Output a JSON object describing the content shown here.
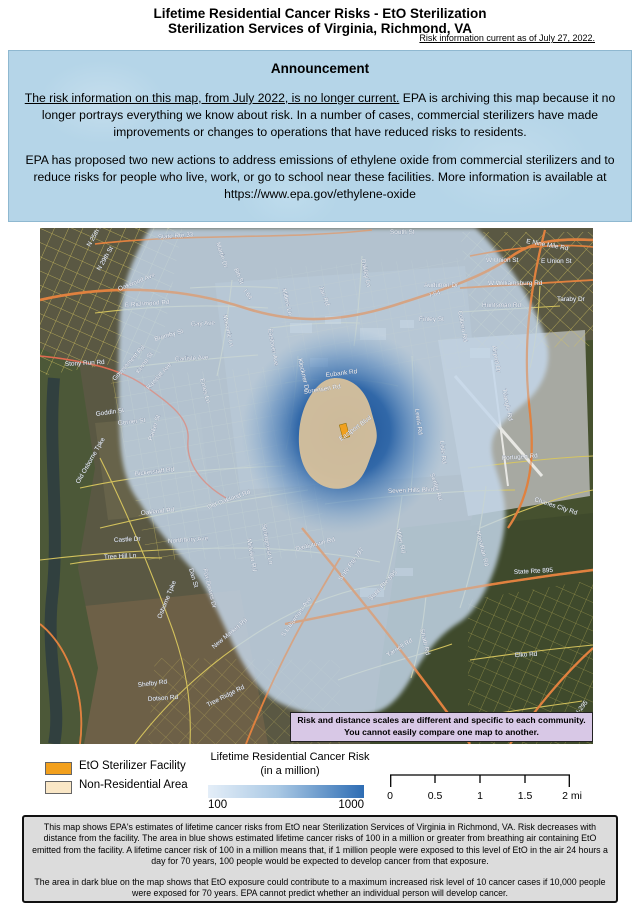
{
  "header": {
    "title1": "Lifetime Residential Cancer Risks - EtO Sterilization",
    "title2": "Sterilization Services of Virginia, Richmond, VA",
    "current_note": "Risk information current as of July 27, 2022."
  },
  "announcement": {
    "heading": "Announcement",
    "p1_underline": "The risk information on this map, from July 2022, is no longer current.",
    "p1_rest": " EPA is archiving this map because it no longer portrays everything we know about risk. In a number of cases, commercial sterilizers have made improvements or changes to operations that have reduced risks to residents.",
    "p2": "EPA has proposed two new actions to address emissions of ethylene oxide from commercial sterilizers and to reduce risks for people who live, work, or go to school near these facilities. More information is available at https://www.epa.gov/ethylene-oxide"
  },
  "map": {
    "note_line1": "Risk and distance scales are different and specific to each community.",
    "note_line2": "You cannot easily compare one map to another.",
    "labels": [
      {
        "text": "State Rte 33"
      },
      {
        "text": "I-64"
      },
      {
        "text": "I-64"
      },
      {
        "text": "Martin Dr"
      },
      {
        "text": "8th St"
      },
      {
        "text": "Masonic Ln"
      },
      {
        "text": "E Richmond Rd"
      },
      {
        "text": "Gay Ave"
      },
      {
        "text": "Bromby St"
      },
      {
        "text": "Kemp St"
      },
      {
        "text": "Carlisle Ave"
      },
      {
        "text": "Randall Ave"
      },
      {
        "text": "Emes Ln"
      },
      {
        "text": "Eastover Ave"
      },
      {
        "text": "Millers Ln"
      },
      {
        "text": "Jan Rd"
      },
      {
        "text": "Klockner Dr"
      },
      {
        "text": "South St"
      },
      {
        "text": "Oakley Ln"
      },
      {
        "text": "Audubon Dr"
      },
      {
        "text": "Finley St"
      },
      {
        "text": "Colleen Rd"
      },
      {
        "text": "E Nine Mile Rd"
      },
      {
        "text": "W Union St"
      },
      {
        "text": "E Union St"
      },
      {
        "text": "W Williamsburg Rd"
      },
      {
        "text": "Huntsman Rd"
      },
      {
        "text": "Taraby Dr"
      },
      {
        "text": "Airport Dr"
      },
      {
        "text": "Eubank Rd"
      },
      {
        "text": "Sorensen Rd"
      },
      {
        "text": "Eastport Blvd"
      },
      {
        "text": "Lewis Rd"
      },
      {
        "text": "Lisle Rd"
      },
      {
        "text": "Settler Rd"
      },
      {
        "text": "Portugee Rd"
      },
      {
        "text": "Triangle Rd"
      },
      {
        "text": "Seven Hills Blvd"
      },
      {
        "text": "Darbytown Rd"
      },
      {
        "text": "Miller Rd"
      },
      {
        "text": "Monahan Rd"
      },
      {
        "text": "State Rte 895"
      },
      {
        "text": "State Rte 895"
      },
      {
        "text": "State Rte 197"
      },
      {
        "text": "Yarnell Rd"
      },
      {
        "text": "Strath Rd"
      },
      {
        "text": "Charles City Rd"
      },
      {
        "text": "Elko Rd"
      },
      {
        "text": "S Laburnum Ave"
      },
      {
        "text": "Bickerstaff Rd"
      },
      {
        "text": "Old Oakland Rd"
      },
      {
        "text": "Oakland Rd"
      },
      {
        "text": "Northbury Ave"
      },
      {
        "text": "Tree Hill Ln"
      },
      {
        "text": "Castle Dr"
      },
      {
        "text": "Fox Downs Dr"
      },
      {
        "text": "Springcrest Ln"
      },
      {
        "text": "Midview Rd"
      },
      {
        "text": "Dan St"
      },
      {
        "text": "Goddin St"
      },
      {
        "text": "Gorner St"
      },
      {
        "text": "Parker St"
      },
      {
        "text": "Old Osborne Tpke"
      },
      {
        "text": "Osborne Tpke"
      },
      {
        "text": "New Market Rd"
      },
      {
        "text": "Tree Ridge Rd"
      },
      {
        "text": "Dotson Rd"
      },
      {
        "text": "Shelby Rd"
      },
      {
        "text": "Stony Run Rd"
      },
      {
        "text": "Government Rd"
      },
      {
        "text": "N 25th St"
      },
      {
        "text": "N 29th St"
      },
      {
        "text": "Oakwood Ave"
      },
      {
        "text": "I-295"
      }
    ]
  },
  "legend": {
    "facility_label": "EtO Sterilizer Facility",
    "non_residential_label": "Non-Residential Area",
    "risk_title": "Lifetime Residential Cancer Risk",
    "risk_subtitle": "(in a million)",
    "scale_min": "100",
    "scale_max": "1000",
    "ticks": [
      "0",
      "0.5",
      "1",
      "1.5",
      "2 mi"
    ]
  },
  "footer": {
    "p1": "This map shows EPA's estimates of lifetime cancer risks from EtO near Sterilization Services of Virginia in Richmond, VA. Risk decreases with distance from the facility. The area in blue shows estimated lifetime cancer risks of 100 in a million or greater from breathing air containing EtO emitted from the facility. A lifetime cancer risk of 100 in a million means that, if 1 million people were exposed to this level of EtO in the air 24 hours a day for 70 years, 100 people would be expected to develop cancer from that exposure.",
    "p2": "The area in dark blue on the map shows that EtO exposure could contribute to a maximum increased risk level of 10 cancer cases if 10,000 people were exposed for 70 years. EPA cannot predict whether an individual person will develop cancer."
  },
  "colors": {
    "facility": "#F2A01D",
    "non_residential_legend": "#FAE7C6",
    "non_residential_map": "#DCC39B",
    "risk_gradient_low": "#E4EEF8",
    "risk_gradient_high": "#2E6DB4",
    "risk_overlay_blue": "#C4D7EA",
    "risk_dark_blue": "#174E94",
    "highway_orange": "#E0813F",
    "road_yellow": "#D9C75E",
    "note_box_purple": "#D8C8E6",
    "announcement_blue": "#B5D5E8",
    "footer_gray": "#DCDCDC"
  }
}
